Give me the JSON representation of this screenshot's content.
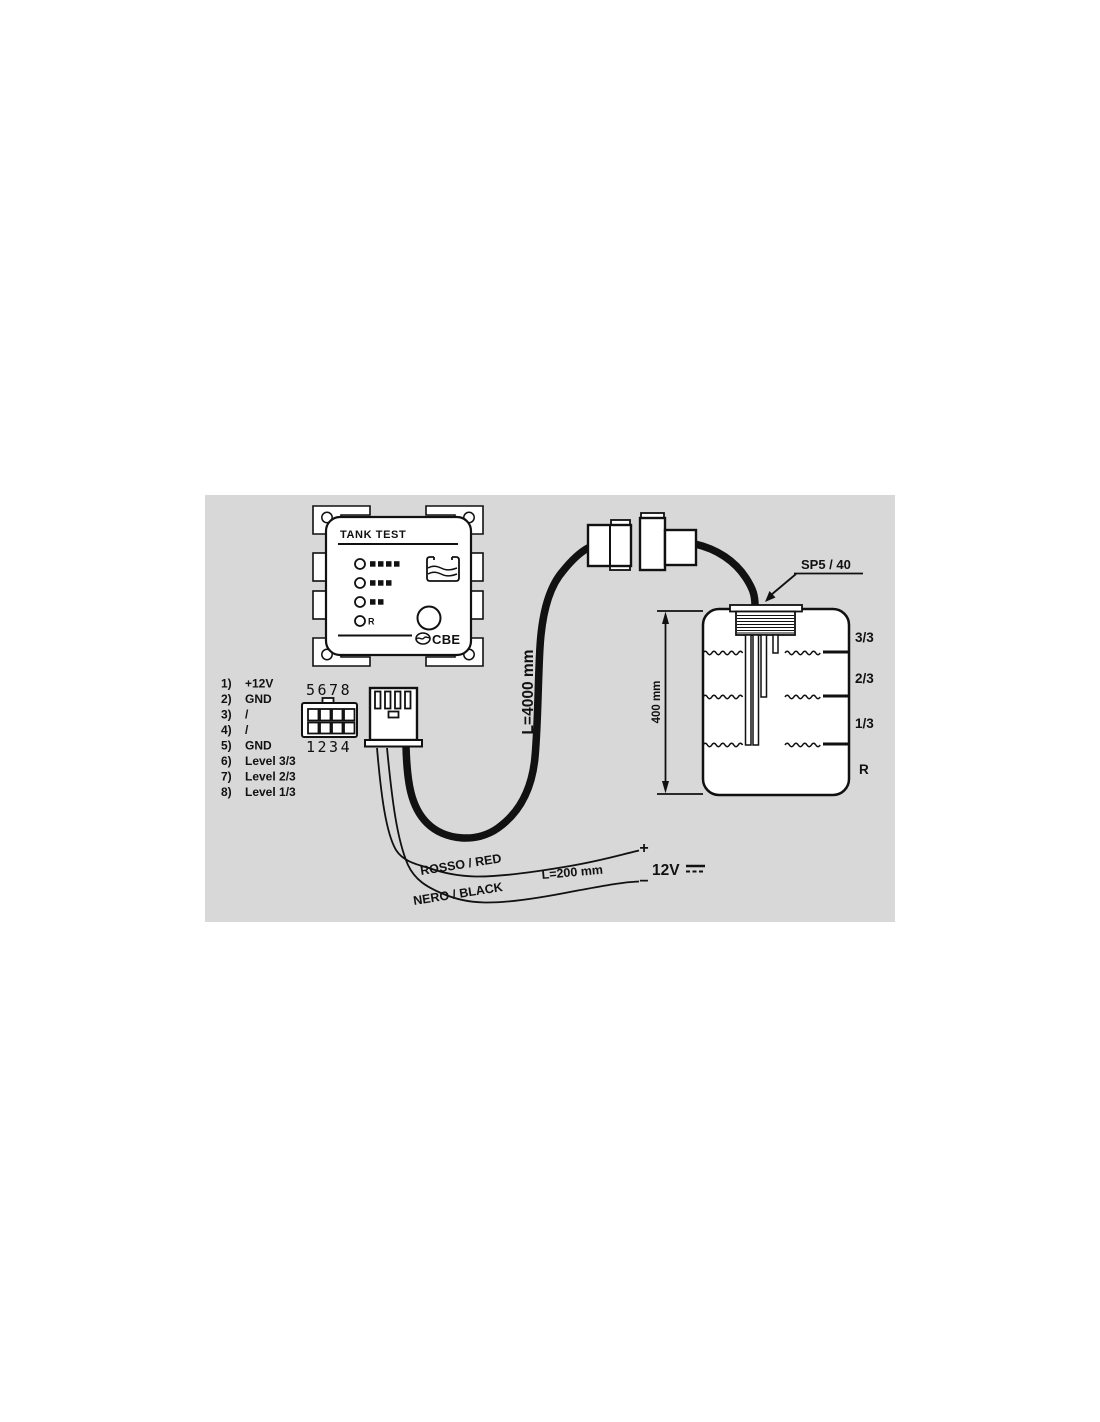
{
  "colors": {
    "diagram_background": "#d8d8d8",
    "line": "#111111",
    "surface": "#ffffff"
  },
  "panel": {
    "title": "TANK TEST",
    "r_label": "R",
    "brand": "CBE",
    "led_rows": [
      {
        "bars": 4
      },
      {
        "bars": 3
      },
      {
        "bars": 2
      },
      {
        "bars": 0,
        "label": "R"
      }
    ]
  },
  "pin_list": [
    {
      "num": "1)",
      "label": "+12V"
    },
    {
      "num": "2)",
      "label": "GND"
    },
    {
      "num": "3)",
      "label": "/"
    },
    {
      "num": "4)",
      "label": "/"
    },
    {
      "num": "5)",
      "label": "GND"
    },
    {
      "num": "6)",
      "label": "Level 3/3"
    },
    {
      "num": "7)",
      "label": "Level 2/3"
    },
    {
      "num": "8)",
      "label": "Level 1/3"
    }
  ],
  "connector": {
    "top_row": "5678",
    "bottom_row": "1234"
  },
  "cable": {
    "length_label": "L=4000 mm"
  },
  "probe": {
    "label": "SP5 / 40"
  },
  "tank": {
    "height_label": "400 mm",
    "levels": [
      "3/3",
      "2/3",
      "1/3",
      "R"
    ]
  },
  "power": {
    "red_label": "ROSSO / RED",
    "black_label": "NERO / BLACK",
    "length_label": "L=200 mm",
    "plus": "+",
    "minus": "−",
    "voltage": "12V"
  }
}
